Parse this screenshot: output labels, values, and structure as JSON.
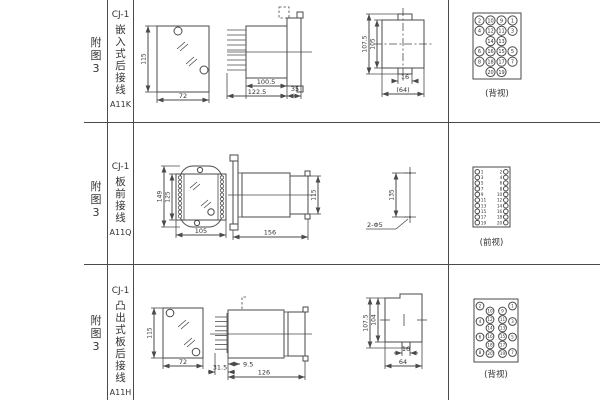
{
  "page": {
    "bg": "#ffffff",
    "line_color": "#4a4a4a",
    "text_color": "#333333"
  },
  "rows": [
    {
      "fig": "附\n图\n3",
      "model": "CJ-1",
      "mount": "嵌\n入\n式\n后\n接\n线",
      "code": "A11K",
      "dims": {
        "front_h": "115",
        "front_w": "72",
        "body_len": "100.5",
        "total_len": "122.5",
        "flange": "35",
        "rear_h_outer": "107.5",
        "rear_h_inner": "105",
        "rear_w_inner": "16",
        "rear_w_outer": "(64)"
      },
      "caption": "(背视)"
    },
    {
      "fig": "附\n图\n3",
      "model": "CJ-1",
      "mount": "板\n前\n接\n线",
      "code": "A11Q",
      "dims": {
        "front_h_outer": "149",
        "front_h_inner": "125",
        "front_w": "105",
        "total_len": "156",
        "body_h": "115",
        "hole_pitch": "135",
        "hole_note": "2-Φ5"
      },
      "caption": "(前视)"
    },
    {
      "fig": "附\n图\n3",
      "model": "CJ-1",
      "mount": "凸\n出\n式\n板\n后\n接\n线",
      "code": "A11H",
      "dims": {
        "front_h": "115",
        "front_w": "72",
        "term_len": "31.5",
        "offset": "9.5",
        "total_len": "126",
        "rear_h_outer": "107.5",
        "rear_h_inner": "104",
        "rear_w_inner": "16",
        "rear_w_outer": "64"
      },
      "caption": "(背视)"
    }
  ],
  "terminals": {
    "back_top": [
      [
        "2",
        "10",
        "9",
        "1"
      ],
      [
        "4",
        "12",
        "11",
        "3"
      ],
      [
        "",
        "14",
        "13",
        ""
      ],
      [
        "6",
        "16",
        "15",
        "5"
      ],
      [
        "8",
        "18",
        "17",
        "7"
      ],
      [
        "",
        "20",
        "19",
        ""
      ]
    ],
    "front": {
      "left": [
        "1",
        "3",
        "5",
        "7",
        "9",
        "11",
        "13",
        "15",
        "17",
        "19"
      ],
      "right": [
        "2",
        "4",
        "6",
        "8",
        "10",
        "12",
        "14",
        "16",
        "18",
        "20"
      ]
    },
    "back_bottom": {
      "outer_left": [
        "2",
        "4",
        "6",
        "8"
      ],
      "inner_left": [
        "10",
        "12",
        "14",
        "16",
        "18",
        "20"
      ],
      "inner_right": [
        "9",
        "11",
        "13",
        "15",
        "17",
        "19"
      ],
      "outer_right": [
        "1",
        "3",
        "5",
        "7"
      ]
    }
  }
}
